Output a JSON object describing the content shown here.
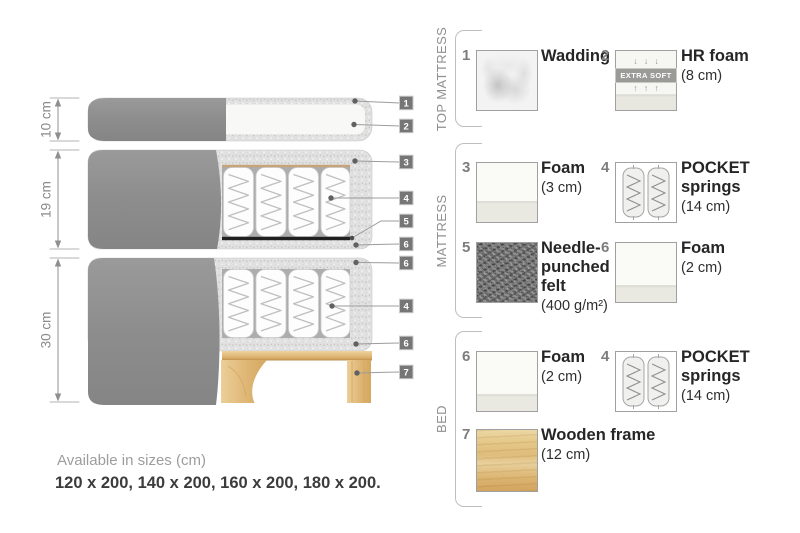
{
  "diagram": {
    "dim_labels": [
      "10 cm",
      "19 cm",
      "30 cm"
    ],
    "callouts": [
      "1",
      "2",
      "3",
      "4",
      "5",
      "6",
      "6",
      "4",
      "6",
      "7"
    ]
  },
  "sections": {
    "top_mattress": "TOP MATTRESS",
    "mattress": "MATTRESS",
    "bed": "BED"
  },
  "legend": {
    "items": [
      {
        "num": "1",
        "name": "Wadding",
        "size": ""
      },
      {
        "num": "2",
        "name": "HR foam",
        "size": "(8 cm)",
        "badge": "EXTRA SOFT",
        "arrows_down": "↓ ↓ ↓",
        "arrows_up": "↑ ↑ ↑"
      },
      {
        "num": "3",
        "name": "Foam",
        "size": "(3 cm)"
      },
      {
        "num": "4",
        "name": "POCKET springs",
        "size": "(14 cm)"
      },
      {
        "num": "5",
        "name": "Needle-punched felt",
        "size": "(400 g/m²)"
      },
      {
        "num": "6",
        "name": "Foam",
        "size": "(2 cm)"
      },
      {
        "num": "6",
        "name": "Foam",
        "size": "(2 cm)"
      },
      {
        "num": "4",
        "name": "POCKET springs",
        "size": "(14 cm)"
      },
      {
        "num": "7",
        "name": "Wooden frame",
        "size": "(12 cm)"
      }
    ]
  },
  "footer": {
    "availability": "Available in sizes (cm)",
    "sizes": "120 x 200, 140 x 200, 160 x 200, 180 x 200."
  },
  "colors": {
    "fabric_gray": "#8d8d8d",
    "speckle_gray": "#e1e1e1",
    "wood": "#e0b878",
    "accent_tan": "#c5a47a",
    "felt_black": "#1f1f1f",
    "tag_gray": "#767676"
  }
}
